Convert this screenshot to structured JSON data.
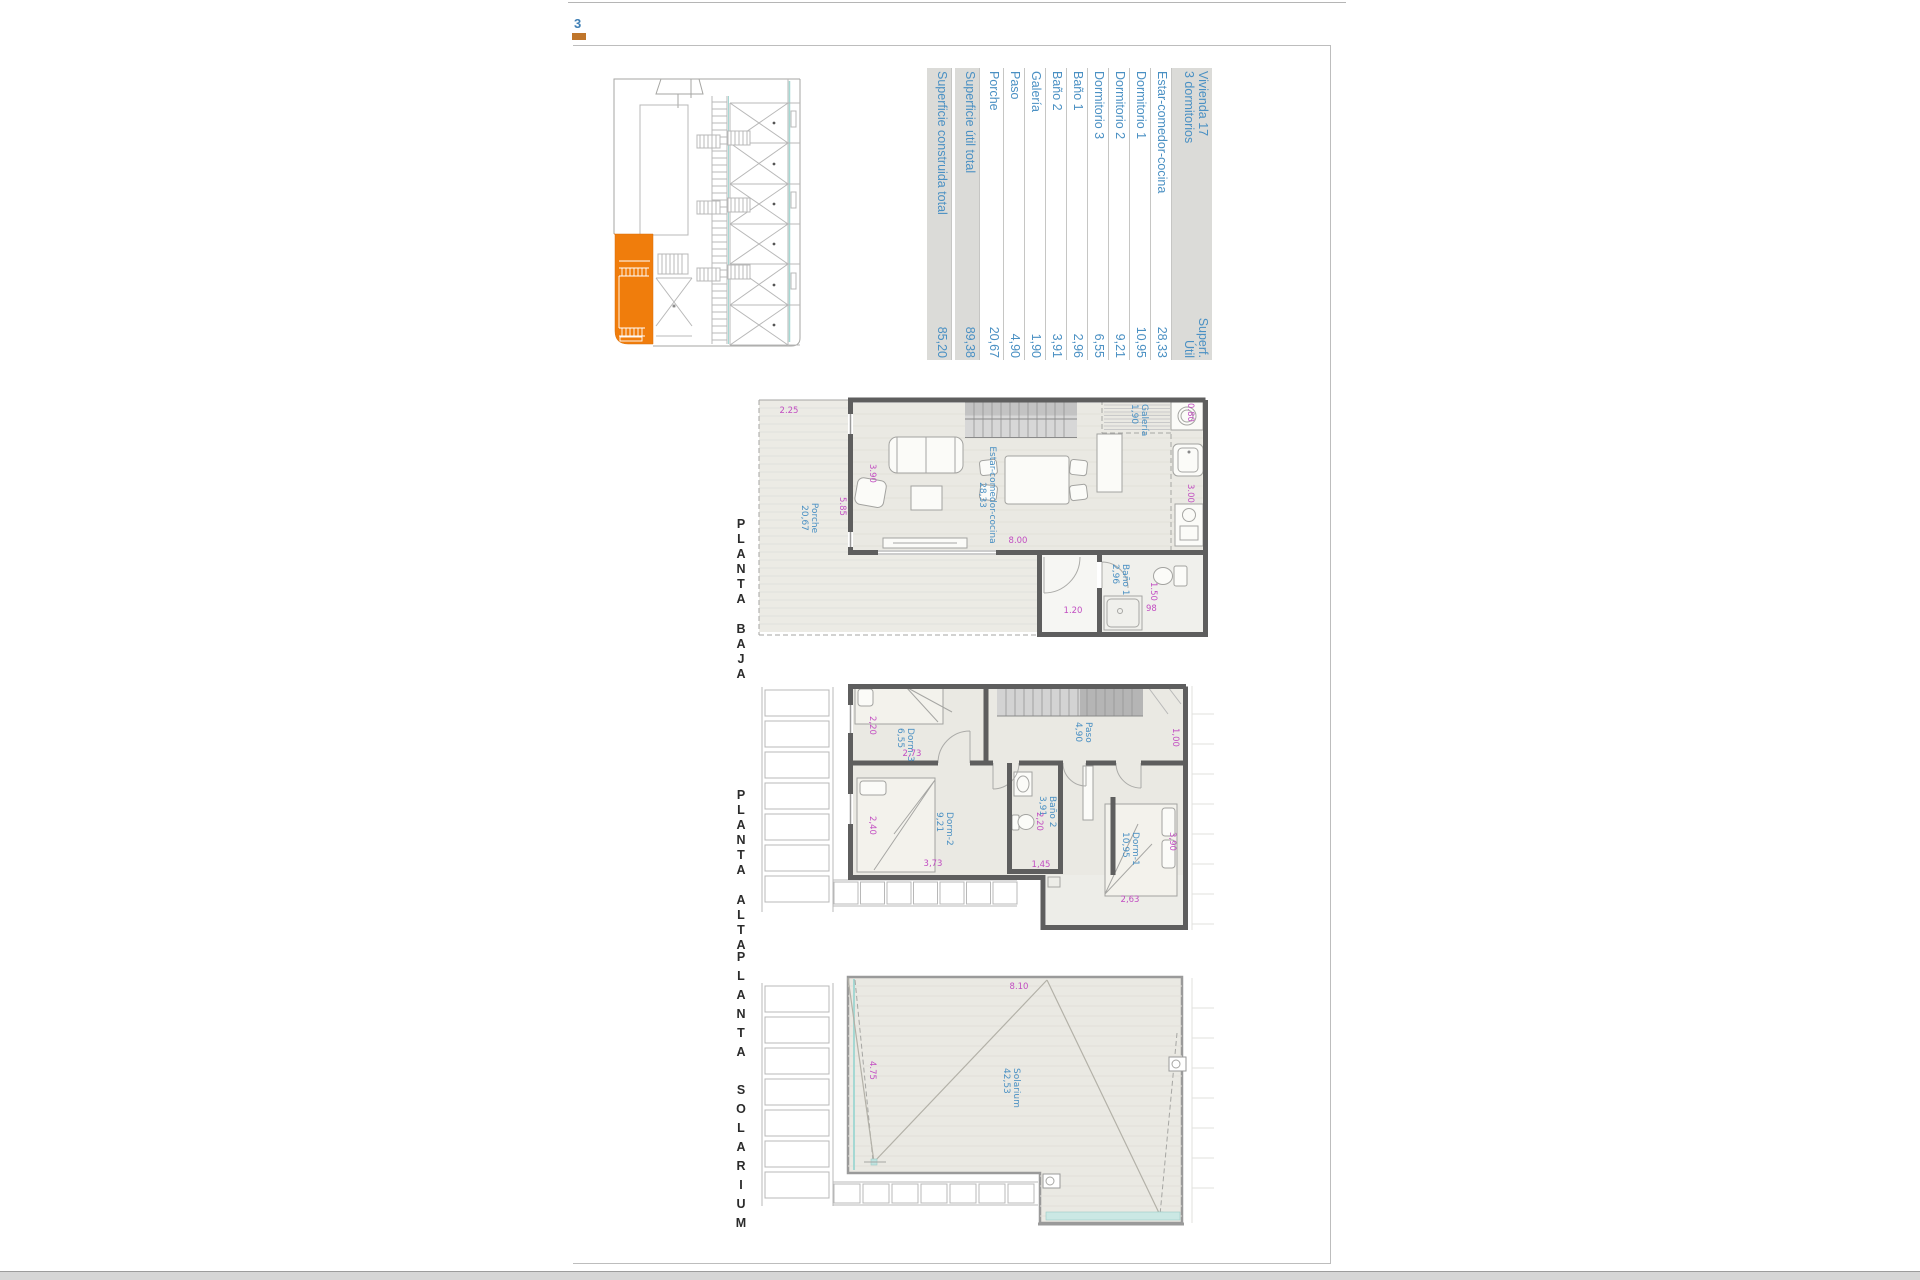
{
  "page": {
    "number": "3"
  },
  "summary_table": {
    "header": {
      "title_line1": "Vivienda 17",
      "title_line2": "3 dormitorios",
      "unit_line1": "Superf.",
      "unit_line2": "Útil"
    },
    "rows": [
      {
        "label": "Estar-comedor-cocina",
        "value": "28,33"
      },
      {
        "label": "Dormitorio 1",
        "value": "10,95"
      },
      {
        "label": "Dormitorio 2",
        "value": "9,21"
      },
      {
        "label": "Dormitorio 3",
        "value": "6,55"
      },
      {
        "label": "Baño 1",
        "value": "2,96"
      },
      {
        "label": "Baño 2",
        "value": "3,91"
      },
      {
        "label": "Galería",
        "value": "1,90"
      },
      {
        "label": "Paso",
        "value": "4,90"
      },
      {
        "label": "Porche",
        "value": "20,67"
      }
    ],
    "totals": [
      {
        "label": "Superficie útil total",
        "value": "89,38"
      },
      {
        "label": "Superficie construida total",
        "value": "85,20"
      }
    ]
  },
  "plans": {
    "baja": {
      "title": "PLANTA BAJA",
      "rooms": {
        "porche": {
          "name": "Porche",
          "area": "20,67"
        },
        "estar": {
          "name": "Estar-comedor-cocina",
          "area": "28,33"
        },
        "galeria": {
          "name": "Galería",
          "area": "1,90"
        },
        "bano1": {
          "name": "Baño 1",
          "area": "2,96"
        }
      },
      "dims": {
        "d1": "2.25",
        "d2": "3.90",
        "d3": "5.85",
        "d4": "8.00",
        "d5": "0.80",
        "d6": "3.00",
        "d7": "1.20",
        "d8": "1.50",
        "d9": "98"
      }
    },
    "alta": {
      "title": "PLANTA ALTA",
      "rooms": {
        "dorm3": {
          "name": "Dorm-3",
          "area": "6,55"
        },
        "paso": {
          "name": "Paso",
          "area": "4,90"
        },
        "dorm2": {
          "name": "Dorm-2",
          "area": "9,21"
        },
        "bano2": {
          "name": "Baño 2",
          "area": "3,91"
        },
        "dorm1": {
          "name": "Dorm-1",
          "area": "10,95"
        }
      },
      "dims": {
        "d1": "2,20",
        "d2": "2,73",
        "d3": "1,00",
        "d4": "2,40",
        "d5": "3,73",
        "d6": "2,20",
        "d7": "1,45",
        "d8": "3,90",
        "d9": "2,63"
      }
    },
    "solarium": {
      "title": "PLANTA SOLARIUM",
      "rooms": {
        "solarium": {
          "name": "Solarium",
          "area": "42,53"
        }
      },
      "dims": {
        "d1": "8.10",
        "d2": "4.75"
      }
    }
  },
  "colors": {
    "highlight_orange": "#F07D0C",
    "label_blue": "#4A90C3",
    "dim_magenta": "#C24EC2"
  }
}
